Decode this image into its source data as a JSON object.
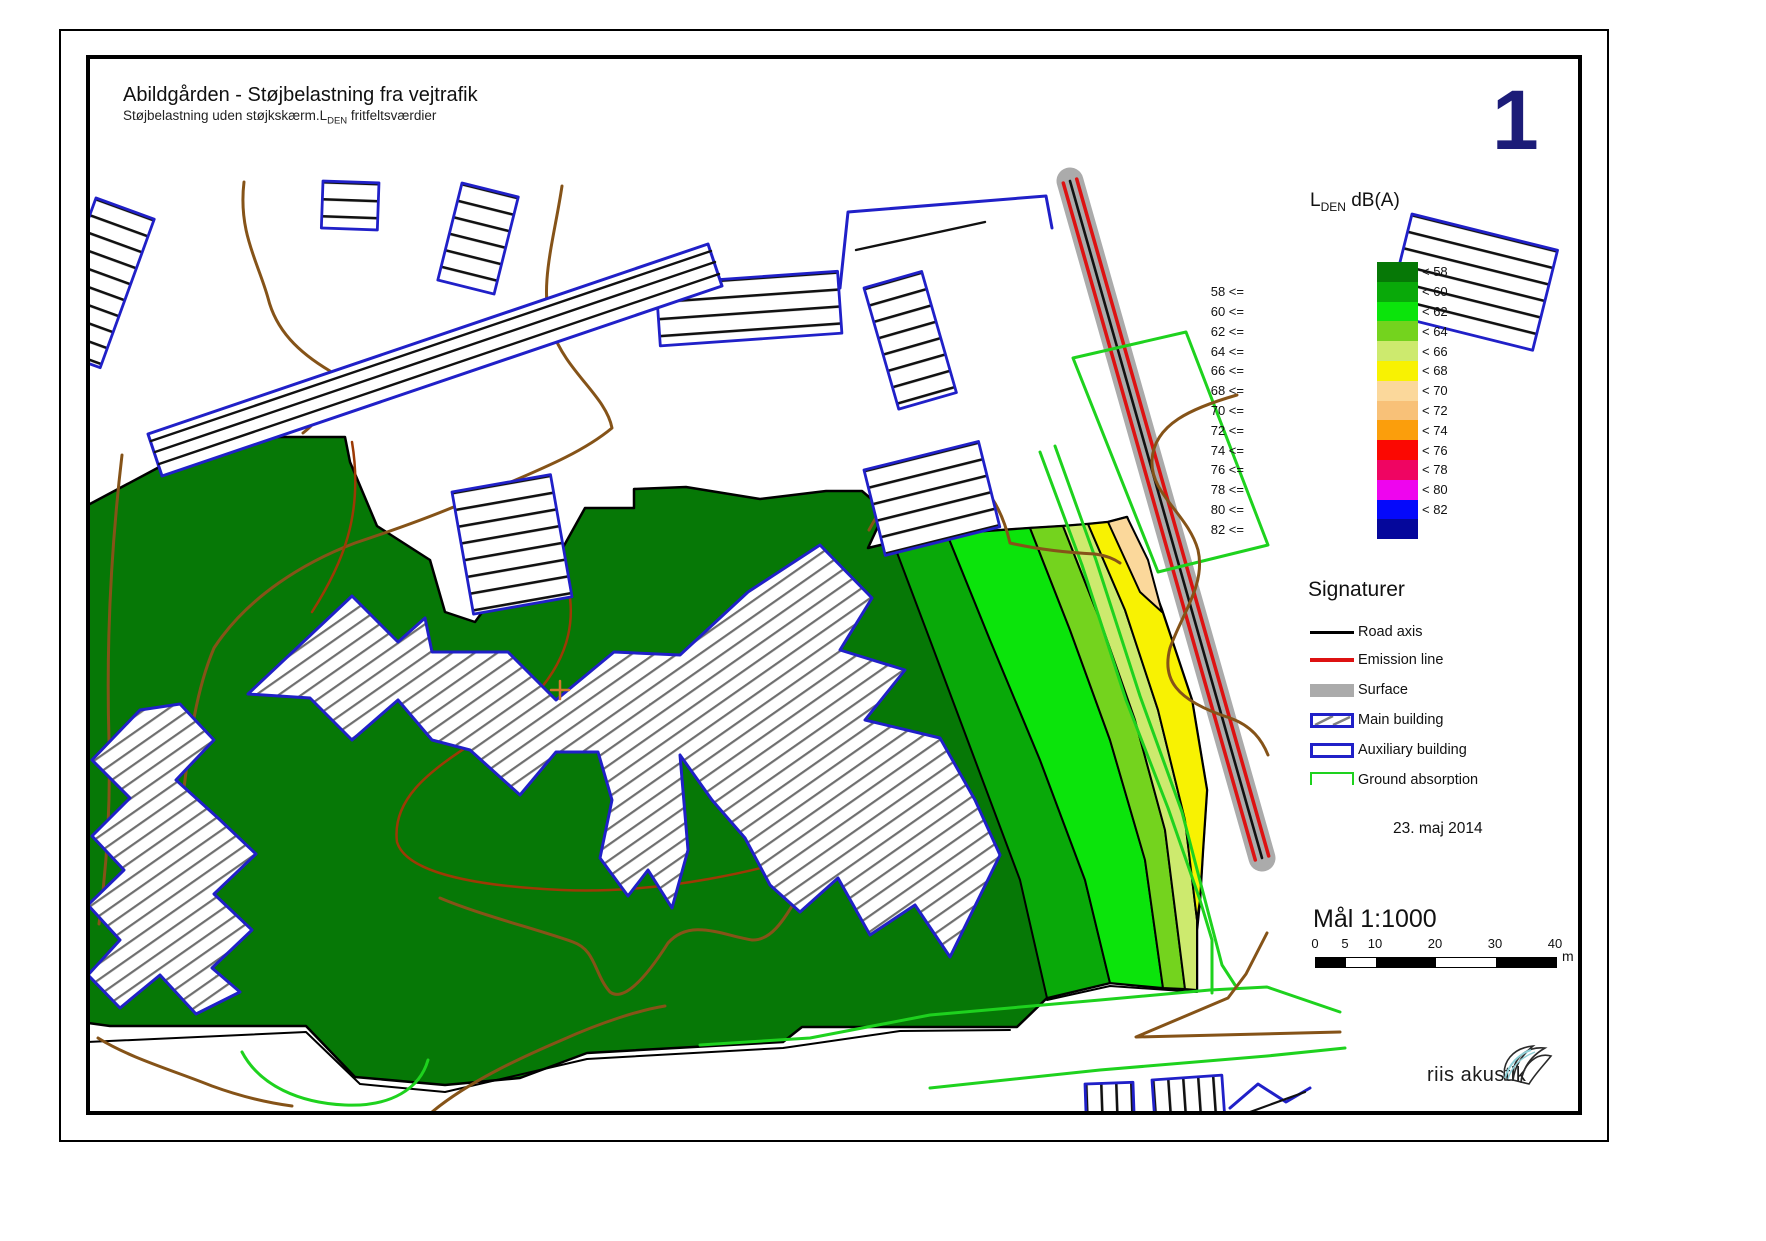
{
  "page": {
    "number": "1",
    "title": "Abildgården - Støjbelastning fra vejtrafik",
    "subtitle_prefix": "Støjbelastning uden støjkskærm.L",
    "subtitle_sub": "DEN",
    "subtitle_suffix": " fritfeltsværdier"
  },
  "legend": {
    "title_main": "L",
    "title_sub": "DEN",
    "title_suffix": " dB(A)",
    "rows": [
      {
        "left": "",
        "right": "< 58",
        "color": "#067806"
      },
      {
        "left": "58 <=",
        "right": "< 60",
        "color": "#09a909"
      },
      {
        "left": "60 <=",
        "right": "< 62",
        "color": "#0be40b"
      },
      {
        "left": "62 <=",
        "right": "< 64",
        "color": "#74d31e"
      },
      {
        "left": "64 <=",
        "right": "< 66",
        "color": "#cdea6e"
      },
      {
        "left": "66 <=",
        "right": "< 68",
        "color": "#f8f202"
      },
      {
        "left": "68 <=",
        "right": "< 70",
        "color": "#fbd89b"
      },
      {
        "left": "70 <=",
        "right": "< 72",
        "color": "#f8c178"
      },
      {
        "left": "72 <=",
        "right": "< 74",
        "color": "#fb9e0c"
      },
      {
        "left": "74 <=",
        "right": "< 76",
        "color": "#fb0802"
      },
      {
        "left": "76 <=",
        "right": "< 78",
        "color": "#ef0562"
      },
      {
        "left": "78 <=",
        "right": "< 80",
        "color": "#ee05ee"
      },
      {
        "left": "80 <=",
        "right": "< 82",
        "color": "#0509fb"
      },
      {
        "left": "82 <=",
        "right": "",
        "color": "#05079b"
      }
    ]
  },
  "signatures": {
    "heading": "Signaturer",
    "items": [
      {
        "label": "Road axis"
      },
      {
        "label": "Emission line"
      },
      {
        "label": "Surface"
      },
      {
        "label": "Main building"
      },
      {
        "label": "Auxiliary building"
      },
      {
        "label": "Ground absorption"
      }
    ]
  },
  "date": "23. maj 2014",
  "scalebar": {
    "label": "Mål 1:1000",
    "ticks": [
      "0",
      "5",
      "10",
      "20",
      "30",
      "40"
    ],
    "unit": "m"
  },
  "logo": {
    "text": "riis akustik"
  },
  "colors": {
    "page_number_navy": "#1c1c78",
    "building_outline_blue": "#2020c8",
    "ground_absorption_green": "#1ed21e",
    "road_surface_gray": "#ababab",
    "emission_line_red": "#dd1111",
    "road_axis_black": "#111111",
    "terrain_contour_brown": "#855318",
    "contour_dark_red": "#9c3a05"
  }
}
